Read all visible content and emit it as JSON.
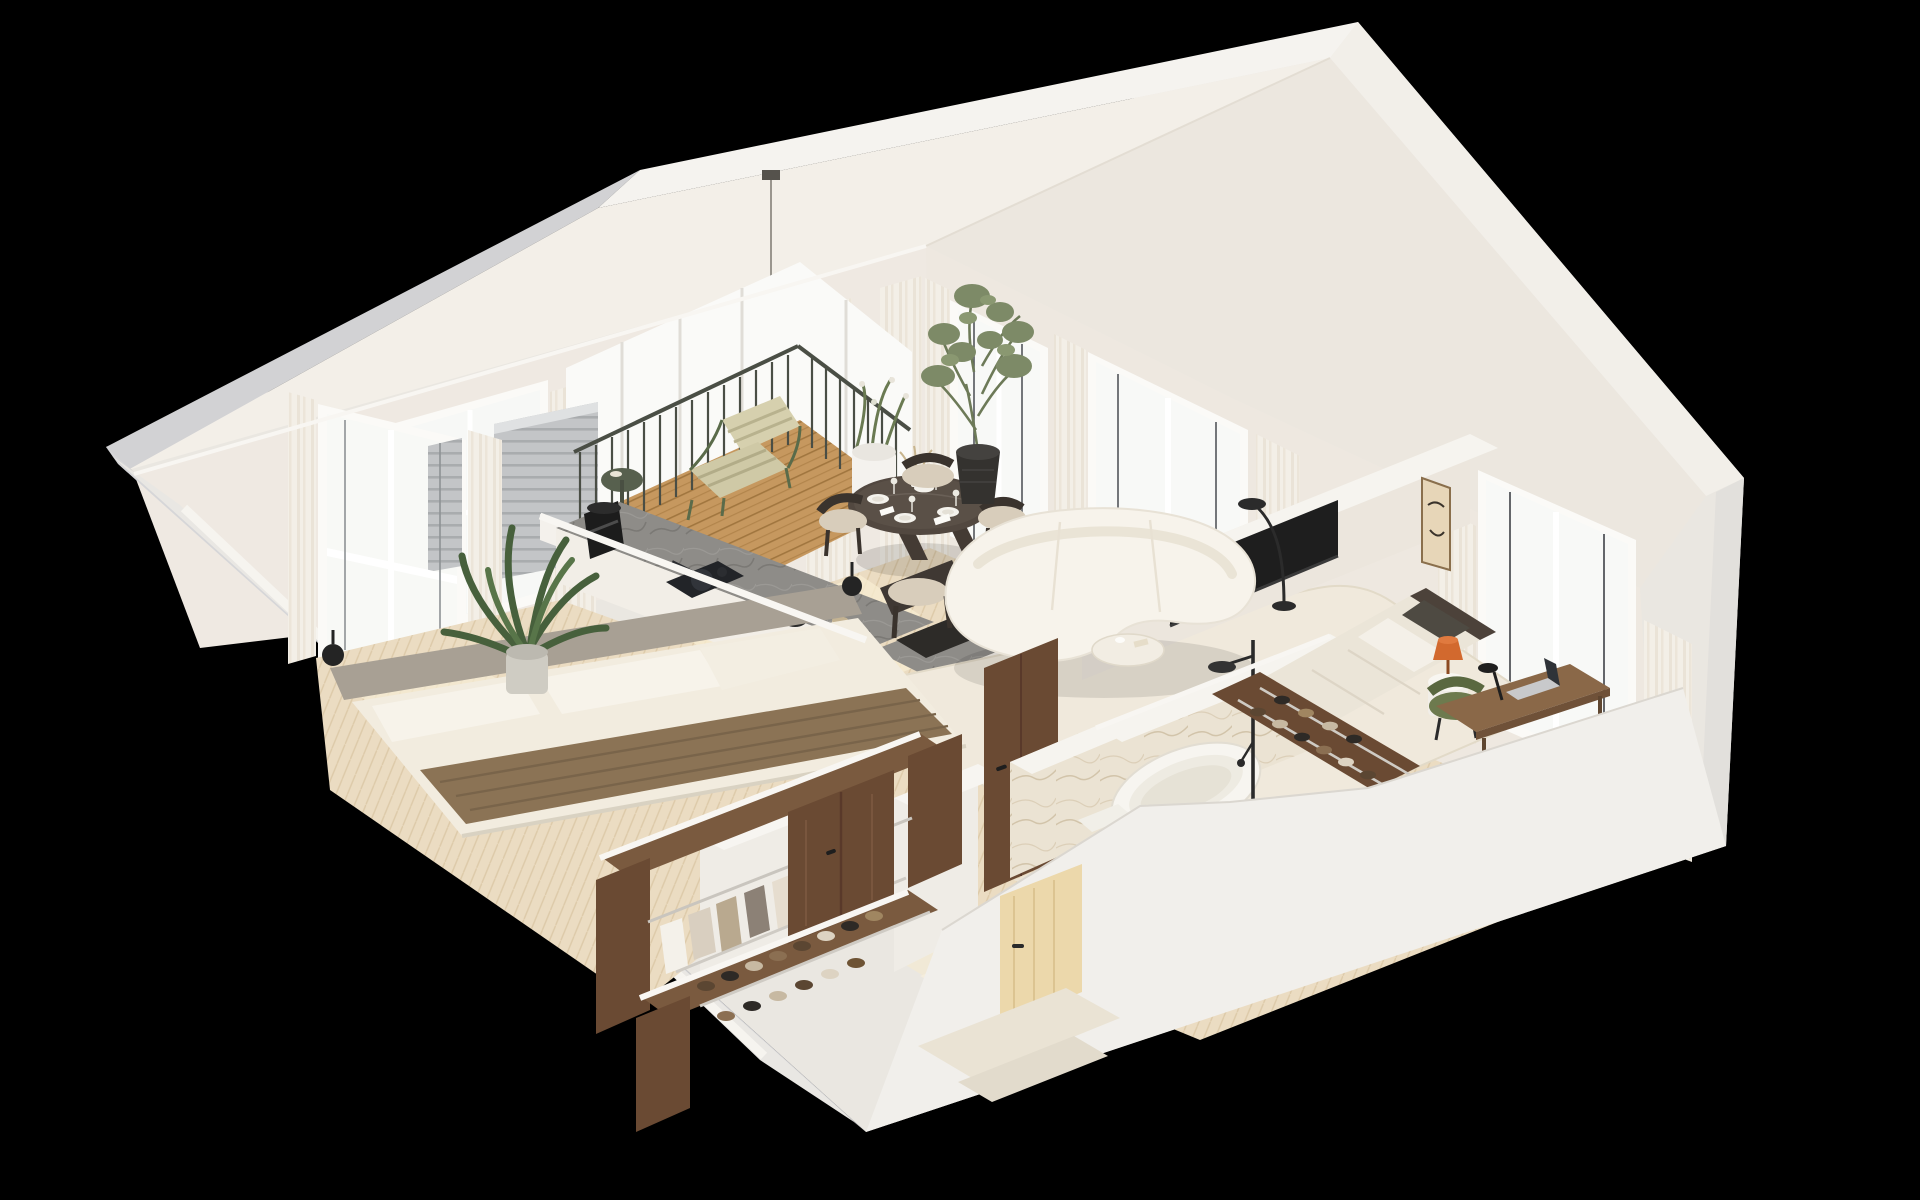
{
  "scene": {
    "type": "3d-isometric-floor-plan-render",
    "description": "High-angle isometric cutaway render of a furnished attic apartment with gabled roof on a black background",
    "background": "#000000"
  },
  "palette": {
    "background": "#000000",
    "roof_gray": "#d2d2d4",
    "roof_light": "#f5f3ef",
    "ceiling": "#f3efe8",
    "ceiling_shade": "#ece7df",
    "wall_ivory": "#efe9e2",
    "wall_shade": "#eee8e0",
    "wall_top_cut": "#f7f5f1",
    "outer_gray": "#d6d6d8",
    "outer_light": "#e9e7e3",
    "outer_bright": "#f1efeb",
    "floor_oak": "#ebdcc2",
    "floor_pale": "#f1e9d6",
    "rug": "#f0e9dc",
    "sofa_boucle": "#f7f3eb",
    "curtain": "#f3efe7",
    "glass": "#f9f9f7",
    "walnut": "#6a4a33",
    "walnut_dark": "#59392a",
    "counter_stone": "#8e8c88",
    "deck_wood": "#c6985f",
    "railing_green": "#4a4e45",
    "plant_green": "#4f6b45",
    "olive_green": "#7d8a67",
    "bed_throw_brown": "#8b7355",
    "linen": "#f2ecdf",
    "headboard_gray": "#a8a094",
    "tv_black": "#1e1e1e",
    "marble": "#ebe3d3",
    "accent_orange": "#d2692e",
    "accent_chair_green": "#6d7a4e",
    "fixture_black": "#2a2a2a",
    "art_beige": "#e9dbc0",
    "door_pale_wood": "#ecd8ab"
  },
  "rooms": [
    {
      "name": "balcony",
      "items": [
        "wood-plank-deck",
        "dark-green-metal-railing",
        "green-lounge-chair-striped-cushions",
        "small-round-side-table",
        "white-cylinder-planter-with-flowering-plant",
        "gray-slatted-screen"
      ]
    },
    {
      "name": "dining-area",
      "items": [
        "round-dark-wood-table",
        "four-dark-frame-beige-chairs",
        "set-tableware-plates-glasses",
        "dried-flower-centerpiece",
        "white-disc-pendant-lamp",
        "olive-tree-in-black-pot",
        "abstract-beige-wall-art"
      ]
    },
    {
      "name": "kitchen",
      "items": [
        "l-shaped-island-counter",
        "gray-stone-countertop",
        "black-coffee-machine",
        "induction-hob-with-pan",
        "kettle",
        "storage-jars",
        "undermount-black-sink",
        "black-faucet"
      ]
    },
    {
      "name": "living-room",
      "items": [
        "curved-white-boucle-sofa",
        "cream-area-rug",
        "round-cream-coffee-table",
        "black-arc-floor-lamp",
        "tv-on-half-wall",
        "tall-windows-with-sheer-curtains"
      ]
    },
    {
      "name": "main-bedroom",
      "items": [
        "double-bed-white-linen",
        "brown-throw-blanket",
        "gray-bolster-headboard",
        "two-black-ball-sconces",
        "large-potted-plant",
        "window-with-sheer-curtains"
      ]
    },
    {
      "name": "walk-in-closet",
      "items": [
        "walnut-wardrobe-panels",
        "hanging-clothes-rail",
        "shoe-shelves-with-shoes"
      ]
    },
    {
      "name": "hallway",
      "items": [
        "pale-wood-entry-door",
        "walnut-interior-doors",
        "shoe-rack",
        "white-partition-walls"
      ]
    },
    {
      "name": "bathroom",
      "items": [
        "freestanding-white-oval-bathtub",
        "black-shower-column-rain-head",
        "beige-marble-clad-walls",
        "toilet",
        "towel-rail"
      ]
    },
    {
      "name": "second-bedroom",
      "items": [
        "bed-dark-headboard-beige-duvet",
        "round-white-side-table",
        "orange-glass-table-lamp",
        "green-tub-desk-chair",
        "wood-desk",
        "open-laptop",
        "black-desk-lamp",
        "gable-windows-with-curtains",
        "abstract-wall-art"
      ]
    }
  ]
}
